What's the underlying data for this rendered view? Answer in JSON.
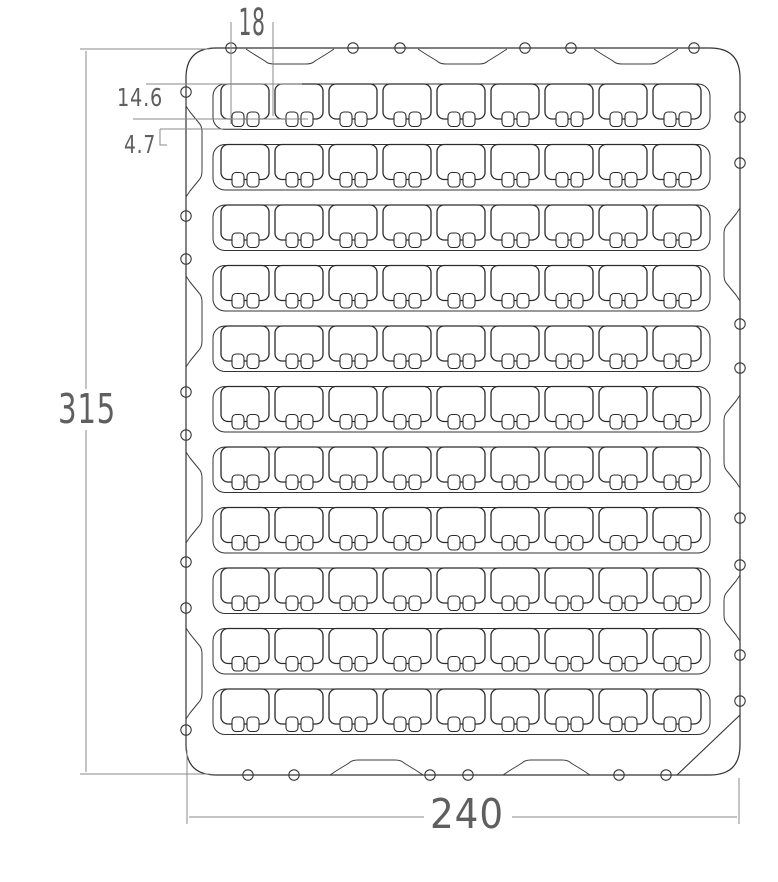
{
  "drawing": {
    "kind": "CAD tray drawing",
    "dimensions": {
      "overall_height": "315",
      "overall_width": "240",
      "pocket_pitch": "18",
      "pocket_height": "14.6",
      "notch_depth": "4.7"
    },
    "grid": {
      "rows": 11,
      "columns": 9,
      "notches_per_pocket": 2
    },
    "features": {
      "top_edge_recesses": 3,
      "bottom_edge_recesses": 2,
      "left_edge_recesses": 4,
      "right_edge_recesses": 3,
      "top_edge_holes": 6,
      "bottom_edge_holes": 6,
      "left_edge_holes": 8,
      "right_edge_holes": 8,
      "chamfer_corner": "bottom-right"
    },
    "colors": {
      "outline": "#333333",
      "pocket_line": "#2b2b2b",
      "dim_line": "#8a8a8a",
      "dim_text": "#5f5f5f",
      "background": "#ffffff"
    }
  }
}
